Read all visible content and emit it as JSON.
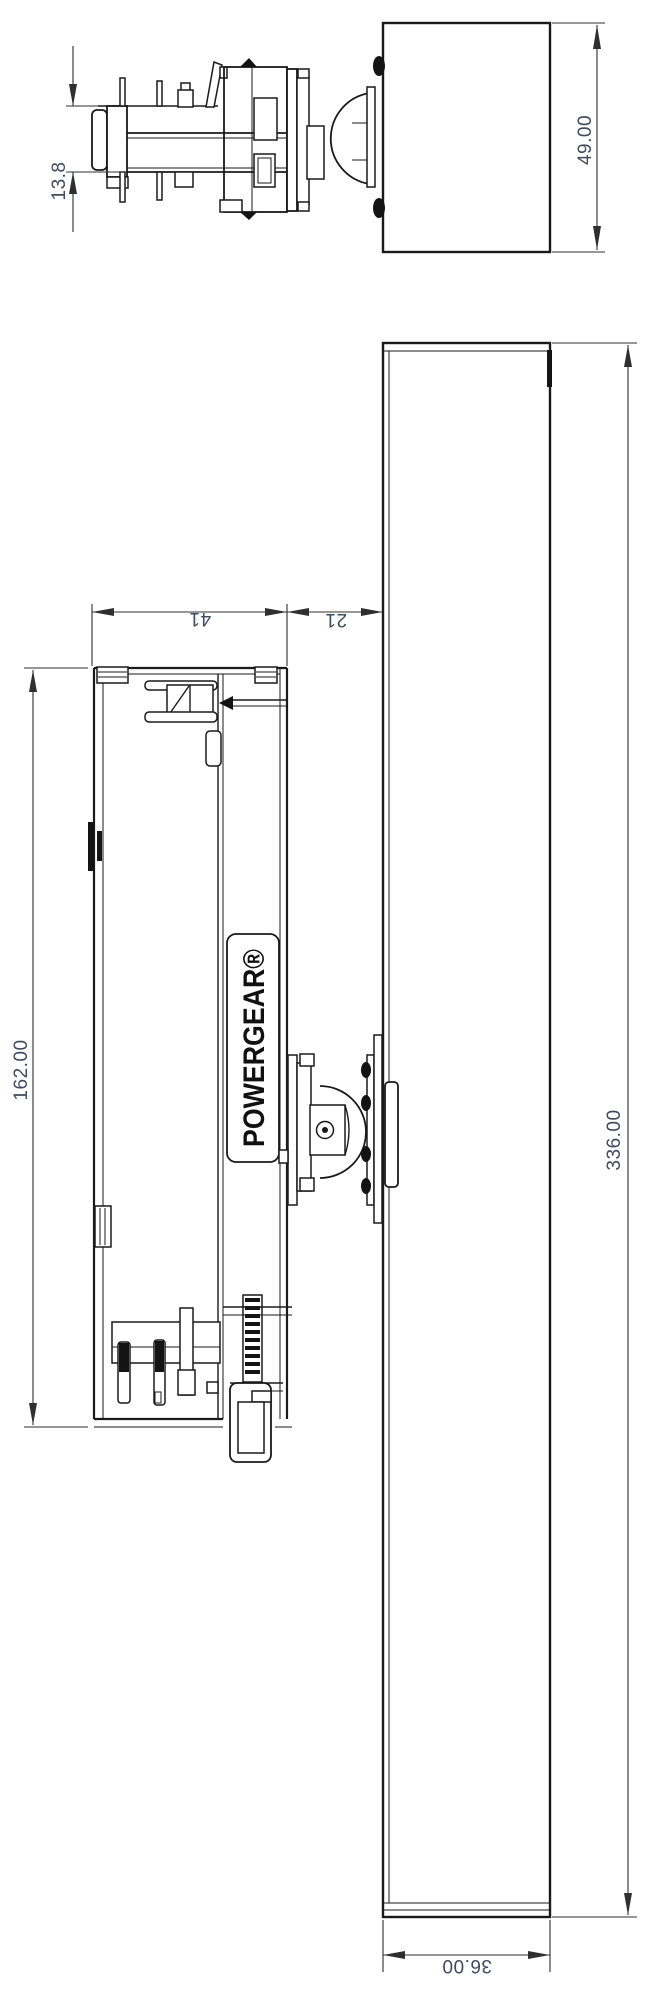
{
  "drawing": {
    "brand_label": "POWERGEAR®",
    "end_view": {
      "stem_height": "13.8",
      "body_height": "49.00"
    },
    "side_view": {
      "body_length": "162.00",
      "body_width": "41",
      "adapter_gap": "21",
      "track_length": "336.00",
      "track_width": "36.00"
    },
    "colors": {
      "line": "#1a1a1a",
      "dim_text": "#3f4b5e"
    }
  }
}
